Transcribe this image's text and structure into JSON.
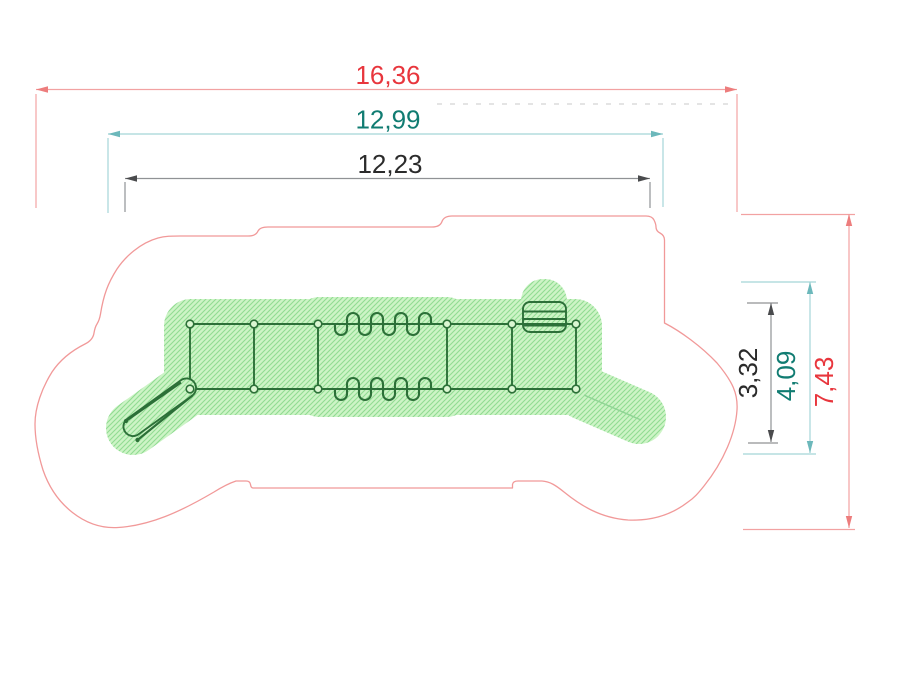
{
  "drawing": {
    "type": "playground-equipment-plan-top-view",
    "dimensions_horizontal": [
      {
        "name": "total-width",
        "value": "16,36"
      },
      {
        "name": "safety-zone-width",
        "value": "12,99"
      },
      {
        "name": "equipment-width",
        "value": "12,23"
      }
    ],
    "dimensions_vertical": [
      {
        "name": "equipment-height",
        "value": "3,32"
      },
      {
        "name": "safety-zone-height",
        "value": "4,09"
      },
      {
        "name": "total-height",
        "value": "7,43"
      }
    ],
    "colors": {
      "total_dimension_text": "#e8363d",
      "total_dimension_line": "#f2a2a2",
      "safety_dimension_text": "#117c72",
      "safety_dimension_line": "#a5d5d8",
      "equipment_dimension_text": "#2b2b2b",
      "equipment_dimension_line": "#909295",
      "safety_outline": "#f19999",
      "impact_area_fill": "#cdf4c6",
      "impact_area_hatch": "#90dc92",
      "equipment_stroke": "#2c7038"
    }
  }
}
